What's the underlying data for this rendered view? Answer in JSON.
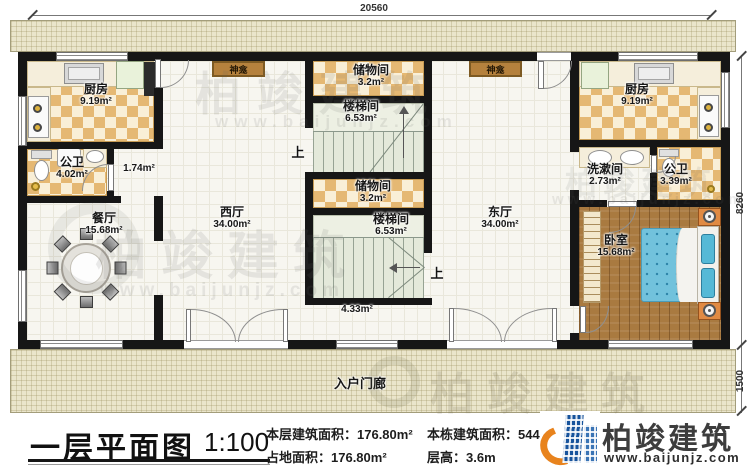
{
  "dimensions": {
    "width": "20560",
    "height_main": "8260",
    "height_porch": "1500"
  },
  "rooms": {
    "kitchen": {
      "name": "厨房",
      "area": "9.19m²"
    },
    "bath_left": {
      "name": "公卫",
      "area": "4.02m²"
    },
    "corridor": {
      "area": "1.74m²"
    },
    "dining": {
      "name": "餐厅",
      "area": "15.68m²"
    },
    "west_hall": {
      "name": "西厅",
      "area": "34.00m²"
    },
    "east_hall": {
      "name": "东厅",
      "area": "34.00m²"
    },
    "shrine": {
      "name": "神龛"
    },
    "storage": {
      "name": "储物间",
      "area": "3.2m²"
    },
    "stairwell": {
      "name": "楼梯间",
      "area": "6.53m²"
    },
    "under_stair": {
      "area": "4.33m²"
    },
    "washroom": {
      "name": "洗漱间",
      "area": "2.73m²"
    },
    "bath_right": {
      "name": "公卫",
      "area": "3.39m²"
    },
    "bedroom": {
      "name": "卧室",
      "area": "15.68m²"
    },
    "porch": {
      "name": "入户门廊"
    }
  },
  "stairs": {
    "up": "上"
  },
  "titleblock": {
    "title": "一层平面图",
    "scale": "1:100",
    "floor_area": "本层建筑面积：176.80m²",
    "footprint": "占地面积：176.80m²",
    "total_area": "本栋建筑面积：544.5m²",
    "story_height": "层高：3.6m"
  },
  "brand": {
    "name": "柏竣建筑",
    "url": "www.baijunjz.com"
  },
  "watermark": {
    "name": "柏竣建筑",
    "url": "www.baijunjz.com"
  }
}
